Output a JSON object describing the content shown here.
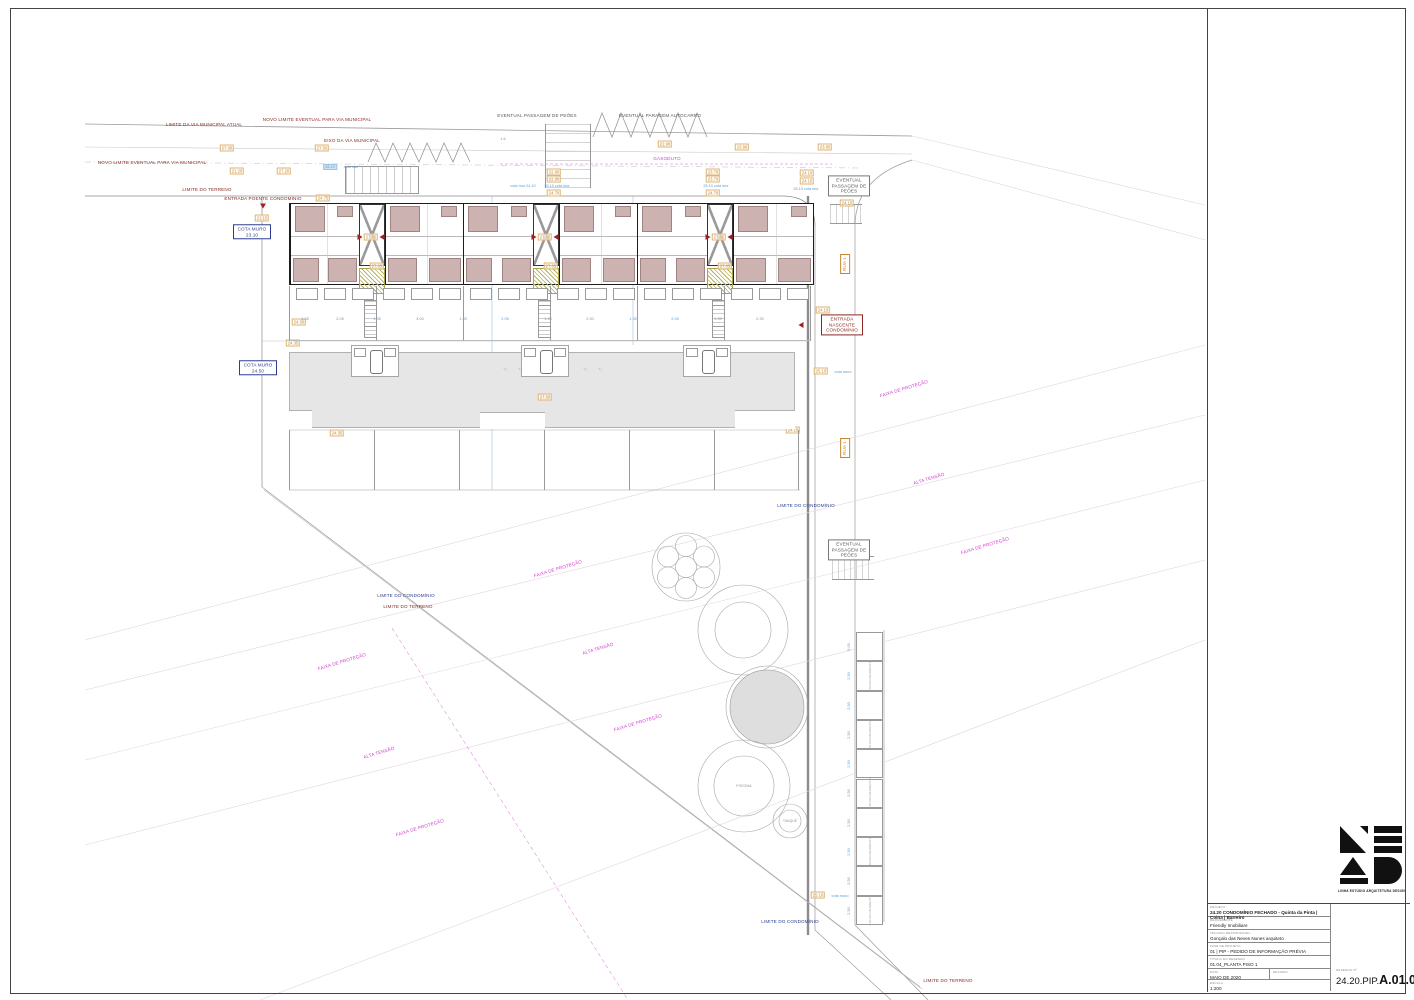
{
  "title_block": {
    "fields": [
      {
        "label": "PROJETO",
        "value": "24.20 CONDOMÍNIO FECHADO - Quinta da Pinta | Coina | Barreiro"
      },
      {
        "label": "REQUERENTE",
        "value": "Friendly Imobiliare"
      },
      {
        "label": "TÉCNICO RESPONSÁVEL",
        "value": "Gonçalo das Neves Nunes arquiteto"
      },
      {
        "label": "FASE DE PROJETO",
        "value": "01 | PIP - PEDIDO DE INFORMAÇÃO PRÉVIA"
      },
      {
        "label": "TÍTULO DO DESENHO",
        "value": "01.04_PLANTA PISO 1"
      }
    ],
    "date_label": "DATA",
    "date": "MAIO DE 2020",
    "revision_label": "REVISÃO",
    "revision": "",
    "scale_label": "ESCALA",
    "scale": "1:200",
    "number_label": "DESENHO Nº",
    "number_prefix": "24.20.PIP.",
    "number": "A.01.04"
  },
  "logo": {
    "caption": "LINHA ESTÚDIO ARQUITETURA DESIGN"
  },
  "plan": {
    "labels": [
      {
        "t": "EVENTUAL PASSAGEM DE PEÕES",
        "x": 537,
        "y": 116,
        "c": "gy2"
      },
      {
        "t": "EVENTUAL PARAGEM AUTOCARRO",
        "x": 660,
        "y": 116,
        "c": "gy2"
      },
      {
        "t": "LIMITE DA VIA MUNICIPAL ATUAL",
        "x": 204,
        "y": 125,
        "c": "dr"
      },
      {
        "t": "NOVO LIMITE EVENTUAL PARA VIA MUNICIPAL",
        "x": 317,
        "y": 120,
        "c": "dr"
      },
      {
        "t": "EIXO DA VIA MUNICIPAL",
        "x": 352,
        "y": 141,
        "c": "dr"
      },
      {
        "t": "NOVO LIMITE EVENTUAL PARA VIA MUNICIPAL",
        "x": 152,
        "y": 163,
        "c": "dr"
      },
      {
        "t": "LIMITE DO TERRENO",
        "x": 207,
        "y": 190,
        "c": "dr"
      },
      {
        "t": "ENTRADA POENTE CONDOMÍNIO",
        "x": 263,
        "y": 199,
        "c": "dr"
      },
      {
        "t": "GASODUTO",
        "x": 667,
        "y": 159,
        "c": "mg"
      },
      {
        "t": "COTA MURO\n23.10",
        "x": 252,
        "y": 232,
        "c": "nv",
        "box": 1,
        "w": 32
      },
      {
        "t": "COTA MURO\n24.50",
        "x": 258,
        "y": 368,
        "c": "nv",
        "box": 1,
        "w": 32
      },
      {
        "t": "EVENTUAL\nPASSAGEM DE\nPEÕES",
        "x": 849,
        "y": 186,
        "c": "gy2",
        "box": 1,
        "w": 36
      },
      {
        "t": "EVENTUAL\nPASSAGEM DE\nPEÕES",
        "x": 849,
        "y": 550,
        "c": "gy2",
        "box": 1,
        "w": 36
      },
      {
        "t": "ENTRADA\nNASCENTE\nCONDOMÍNIO",
        "x": 842,
        "y": 325,
        "c": "dr",
        "box": 1,
        "w": 36
      },
      {
        "t": "LIMITE DO CONDOMÍNIO",
        "x": 806,
        "y": 506,
        "c": "nv"
      },
      {
        "t": "LIMITE DO CONDOMÍNIO",
        "x": 406,
        "y": 596,
        "c": "nv"
      },
      {
        "t": "LIMITE DO TERRENO",
        "x": 408,
        "y": 607,
        "c": "dr"
      },
      {
        "t": "LIMITE DO CONDOMÍNIO",
        "x": 790,
        "y": 922,
        "c": "nv"
      },
      {
        "t": "LIMITE DO TERRENO",
        "x": 948,
        "y": 981,
        "c": "dr"
      },
      {
        "t": "RUA 1",
        "x": 845,
        "y": 264,
        "c": "or",
        "box": 1,
        "r": -90
      },
      {
        "t": "RUA 1",
        "x": 845,
        "y": 448,
        "c": "or",
        "box": 1,
        "r": -90
      },
      {
        "t": "FAIXA DE PROTEÇÃO",
        "x": 558,
        "y": 569,
        "c": "mg",
        "r": -17
      },
      {
        "t": "FAIXA DE PROTEÇÃO",
        "x": 904,
        "y": 389,
        "c": "mg",
        "r": -17
      },
      {
        "t": "ALTA TENSÃO",
        "x": 929,
        "y": 479,
        "c": "mg",
        "r": -17
      },
      {
        "t": "FAIXA DE PROTEÇÃO",
        "x": 985,
        "y": 546,
        "c": "mg",
        "r": -17
      },
      {
        "t": "ALTA TENSÃO",
        "x": 598,
        "y": 649,
        "c": "mg",
        "r": -17
      },
      {
        "t": "FAIXA DE PROTEÇÃO",
        "x": 342,
        "y": 662,
        "c": "mg",
        "r": -17
      },
      {
        "t": "ALTA TENSÃO",
        "x": 379,
        "y": 753,
        "c": "mg",
        "r": -17
      },
      {
        "t": "FAIXA DE PROTEÇÃO",
        "x": 638,
        "y": 723,
        "c": "mg",
        "r": -17
      },
      {
        "t": "FAIXA DE PROTEÇÃO",
        "x": 420,
        "y": 828,
        "c": "mg",
        "r": -17
      },
      {
        "t": "PISCINA",
        "x": 744,
        "y": 786,
        "c": "gy",
        "s": 3.6
      },
      {
        "t": "TANQUE",
        "x": 790,
        "y": 821,
        "c": "gy",
        "s": 3.2
      }
    ],
    "chips": [
      [
        227,
        148,
        "27.30"
      ],
      [
        322,
        148,
        "27.50"
      ],
      [
        665,
        144,
        "22.90"
      ],
      [
        742,
        147,
        "23.90"
      ],
      [
        825,
        147,
        "23.80"
      ],
      [
        237,
        171,
        "21.20"
      ],
      [
        284,
        171,
        "27.20"
      ],
      [
        554,
        172,
        "22.90"
      ],
      [
        554,
        179,
        "22.90"
      ],
      [
        554,
        193,
        "24.70"
      ],
      [
        713,
        172,
        "23.70"
      ],
      [
        713,
        179,
        "23.70"
      ],
      [
        713,
        193,
        "24.70"
      ],
      [
        323,
        198,
        "24.75"
      ],
      [
        262,
        218,
        "21.15"
      ],
      [
        807,
        173,
        "24.10"
      ],
      [
        807,
        181,
        "24.10"
      ],
      [
        847,
        203,
        "24.10"
      ],
      [
        823,
        310,
        "24.10"
      ],
      [
        821,
        371,
        "25.10"
      ],
      [
        818,
        895,
        "25.10"
      ],
      [
        545,
        397,
        "27.60"
      ],
      [
        299,
        322,
        "24.30"
      ],
      [
        293,
        343,
        "24.35"
      ],
      [
        337,
        433,
        "24.35"
      ],
      [
        793,
        430,
        "24.15"
      ],
      [
        371,
        237,
        "27.05"
      ],
      [
        545,
        237,
        "27.05"
      ],
      [
        719,
        237,
        "27.05"
      ],
      [
        377,
        266,
        "27.05"
      ],
      [
        551,
        266,
        "27.05"
      ],
      [
        725,
        266,
        "27.05"
      ]
    ],
    "bluedims": [
      {
        "x": 503,
        "y": 139,
        "t": "1.6"
      },
      {
        "x": 330,
        "y": 167,
        "t": "26.10",
        "bg": 1
      },
      {
        "x": 351,
        "y": 167,
        "t": "cota mur"
      },
      {
        "x": 523,
        "y": 186,
        "t": "cota mur 24.10"
      },
      {
        "x": 557,
        "y": 186,
        "t": "25.10 cota mur"
      },
      {
        "x": 716,
        "y": 186,
        "t": "25.10 cota mur"
      },
      {
        "x": 806,
        "y": 189,
        "t": "25.10 cota mur"
      },
      {
        "x": 843,
        "y": 372,
        "t": "cota muro"
      },
      {
        "x": 840,
        "y": 896,
        "t": "cota muro"
      },
      {
        "x": 305,
        "y": 319,
        "t": "1.35"
      },
      {
        "x": 340,
        "y": 319,
        "t": "2.05"
      },
      {
        "x": 377,
        "y": 319,
        "t": "1.35"
      },
      {
        "x": 420,
        "y": 319,
        "t": "3.00"
      },
      {
        "x": 463,
        "y": 319,
        "t": "1.35"
      },
      {
        "x": 505,
        "y": 319,
        "t": "2.05"
      },
      {
        "x": 548,
        "y": 319,
        "t": "1.35"
      },
      {
        "x": 590,
        "y": 319,
        "t": "2.30"
      },
      {
        "x": 633,
        "y": 319,
        "t": "1.35"
      },
      {
        "x": 675,
        "y": 319,
        "t": "2.05"
      },
      {
        "x": 718,
        "y": 319,
        "t": "1.35"
      },
      {
        "x": 760,
        "y": 319,
        "t": "2.30"
      },
      {
        "x": 849,
        "y": 647,
        "t": "5.00",
        "r": -90
      },
      {
        "x": 849,
        "y": 676,
        "t": "2.50",
        "r": -90
      },
      {
        "x": 849,
        "y": 706,
        "t": "2.50",
        "r": -90
      },
      {
        "x": 849,
        "y": 735,
        "t": "2.50",
        "r": -90
      },
      {
        "x": 849,
        "y": 764,
        "t": "2.50",
        "r": -90
      },
      {
        "x": 849,
        "y": 793,
        "t": "2.50",
        "r": -90
      },
      {
        "x": 849,
        "y": 823,
        "t": "2.50",
        "r": -90
      },
      {
        "x": 849,
        "y": 852,
        "t": "2.50",
        "r": -90
      },
      {
        "x": 849,
        "y": 881,
        "t": "2.50",
        "r": -90
      },
      {
        "x": 849,
        "y": 911,
        "t": "2.50",
        "r": -90
      }
    ],
    "markers": [
      {
        "k": "down",
        "x": 263,
        "y": 206
      },
      {
        "k": "left",
        "x": 801,
        "y": 325
      },
      {
        "k": "right",
        "x": 360,
        "y": 237
      },
      {
        "k": "left",
        "x": 382,
        "y": 237
      },
      {
        "k": "right",
        "x": 534,
        "y": 237
      },
      {
        "k": "left",
        "x": 556,
        "y": 237
      },
      {
        "k": "right",
        "x": 708,
        "y": 237
      },
      {
        "k": "left",
        "x": 730,
        "y": 237
      },
      {
        "k": "ppl",
        "x": 505,
        "y": 369
      },
      {
        "k": "ppl",
        "x": 520,
        "y": 369
      },
      {
        "k": "ppl",
        "x": 585,
        "y": 369
      },
      {
        "k": "ppl",
        "x": 600,
        "y": 369
      }
    ],
    "building": {
      "units": [
        {
          "x": 289,
          "w": 69
        },
        {
          "x": 384,
          "w": 78
        },
        {
          "x": 462,
          "w": 70
        },
        {
          "x": 558,
          "w": 78
        },
        {
          "x": 636,
          "w": 70
        },
        {
          "x": 732,
          "w": 80
        }
      ],
      "cores": [
        358,
        532,
        706
      ]
    },
    "plots": {
      "dividers": [
        289,
        376,
        463,
        550,
        637,
        724,
        811
      ],
      "y1": 286,
      "y2": 341,
      "ladders": [
        364,
        538,
        712
      ]
    },
    "gardens": {
      "dividers": [
        289,
        374,
        459,
        544,
        629,
        714,
        799
      ],
      "y1": 430,
      "y2": 490
    },
    "deck": {
      "cuts": [
        350,
        520,
        682
      ],
      "cutW": 48,
      "notches": [
        [
          289,
          410,
          23,
          18
        ],
        [
          480,
          412,
          65,
          16
        ],
        [
          735,
          410,
          60,
          18
        ]
      ]
    },
    "parking": {
      "x": 856,
      "y": 632,
      "w": 27,
      "h": 29.3,
      "count": 10,
      "label": "ESTACIONAMENTO"
    }
  }
}
